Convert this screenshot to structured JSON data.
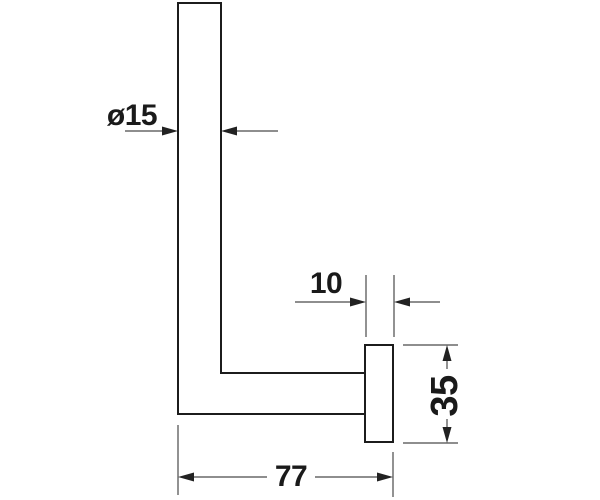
{
  "drawing": {
    "type": "technical-dimension-drawing",
    "subject": "L-shaped wall-mounted holder, side profile with mounting plate",
    "units": "mm",
    "dimensions": [
      {
        "name": "bar-diameter",
        "label": "ø15",
        "value": 15,
        "kind": "diameter",
        "orientation": "horizontal"
      },
      {
        "name": "plate-depth",
        "label": "10",
        "value": 10,
        "kind": "linear",
        "orientation": "horizontal"
      },
      {
        "name": "plate-height",
        "label": "35",
        "value": 35,
        "kind": "linear",
        "orientation": "vertical"
      },
      {
        "name": "overall-depth",
        "label": "77",
        "value": 77,
        "kind": "linear",
        "orientation": "horizontal"
      }
    ],
    "colors": {
      "background": "#ffffff",
      "outline": "#1c1c1c",
      "dimension_line": "#4a4a4a",
      "arrowhead": "#222222",
      "text": "#1a1a1a"
    }
  }
}
